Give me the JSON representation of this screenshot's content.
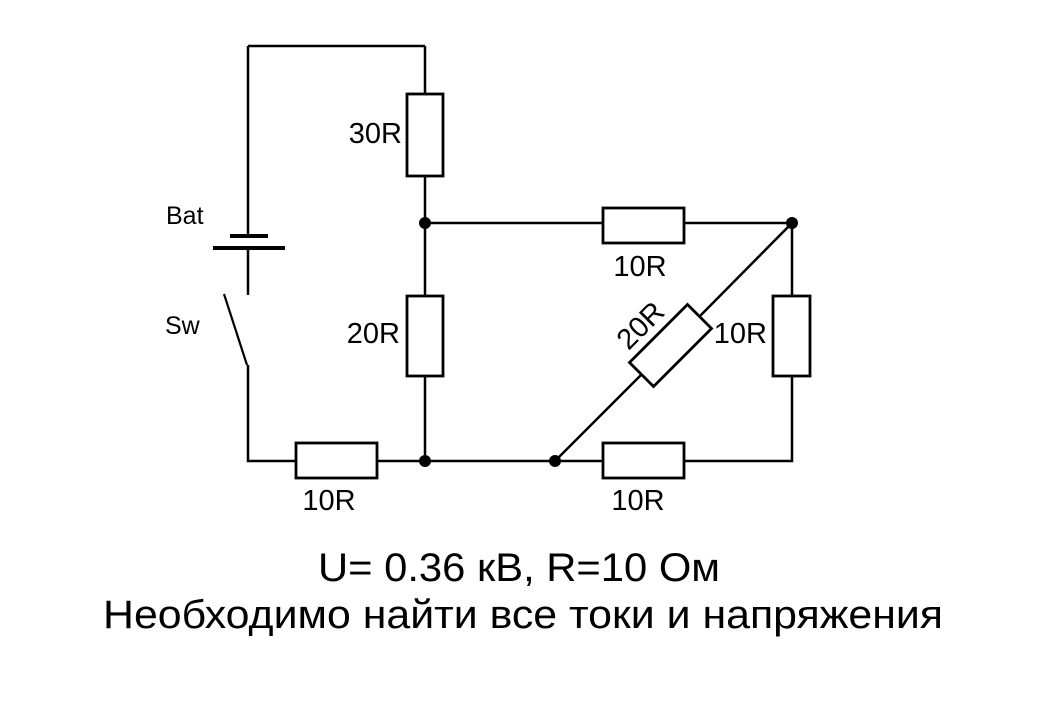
{
  "diagram": {
    "kind": "electrical-circuit-schematic",
    "colors": {
      "background": "#ffffff",
      "ink": "#000000"
    },
    "labels": {
      "battery": "Bat",
      "switch": "Sw",
      "r30_top": "30R",
      "r20_middle": "20R",
      "r10_top_branch": "10R",
      "r20_diagonal": "20R",
      "r10_right_branch": "10R",
      "r10_bottom_left": "10R",
      "r10_bottom_right": "10R"
    },
    "components": [
      {
        "id": "battery",
        "type": "battery",
        "label": "Bat"
      },
      {
        "id": "switch",
        "type": "switch-open",
        "label": "Sw"
      },
      {
        "id": "r1",
        "type": "resistor",
        "label": "30R",
        "position": "top-vertical"
      },
      {
        "id": "r2",
        "type": "resistor",
        "label": "20R",
        "position": "middle-vertical"
      },
      {
        "id": "r3",
        "type": "resistor",
        "label": "10R",
        "position": "top-horizontal"
      },
      {
        "id": "r4",
        "type": "resistor",
        "label": "20R",
        "position": "diagonal"
      },
      {
        "id": "r5",
        "type": "resistor",
        "label": "10R",
        "position": "right-vertical"
      },
      {
        "id": "r6",
        "type": "resistor",
        "label": "10R",
        "position": "bottom-left-horizontal"
      },
      {
        "id": "r7",
        "type": "resistor",
        "label": "10R",
        "position": "bottom-right-horizontal"
      }
    ],
    "caption": {
      "line1": "U= 0.36 кВ, R=10 Ом",
      "line2": "Необходимо найти все токи и напряжения"
    }
  }
}
